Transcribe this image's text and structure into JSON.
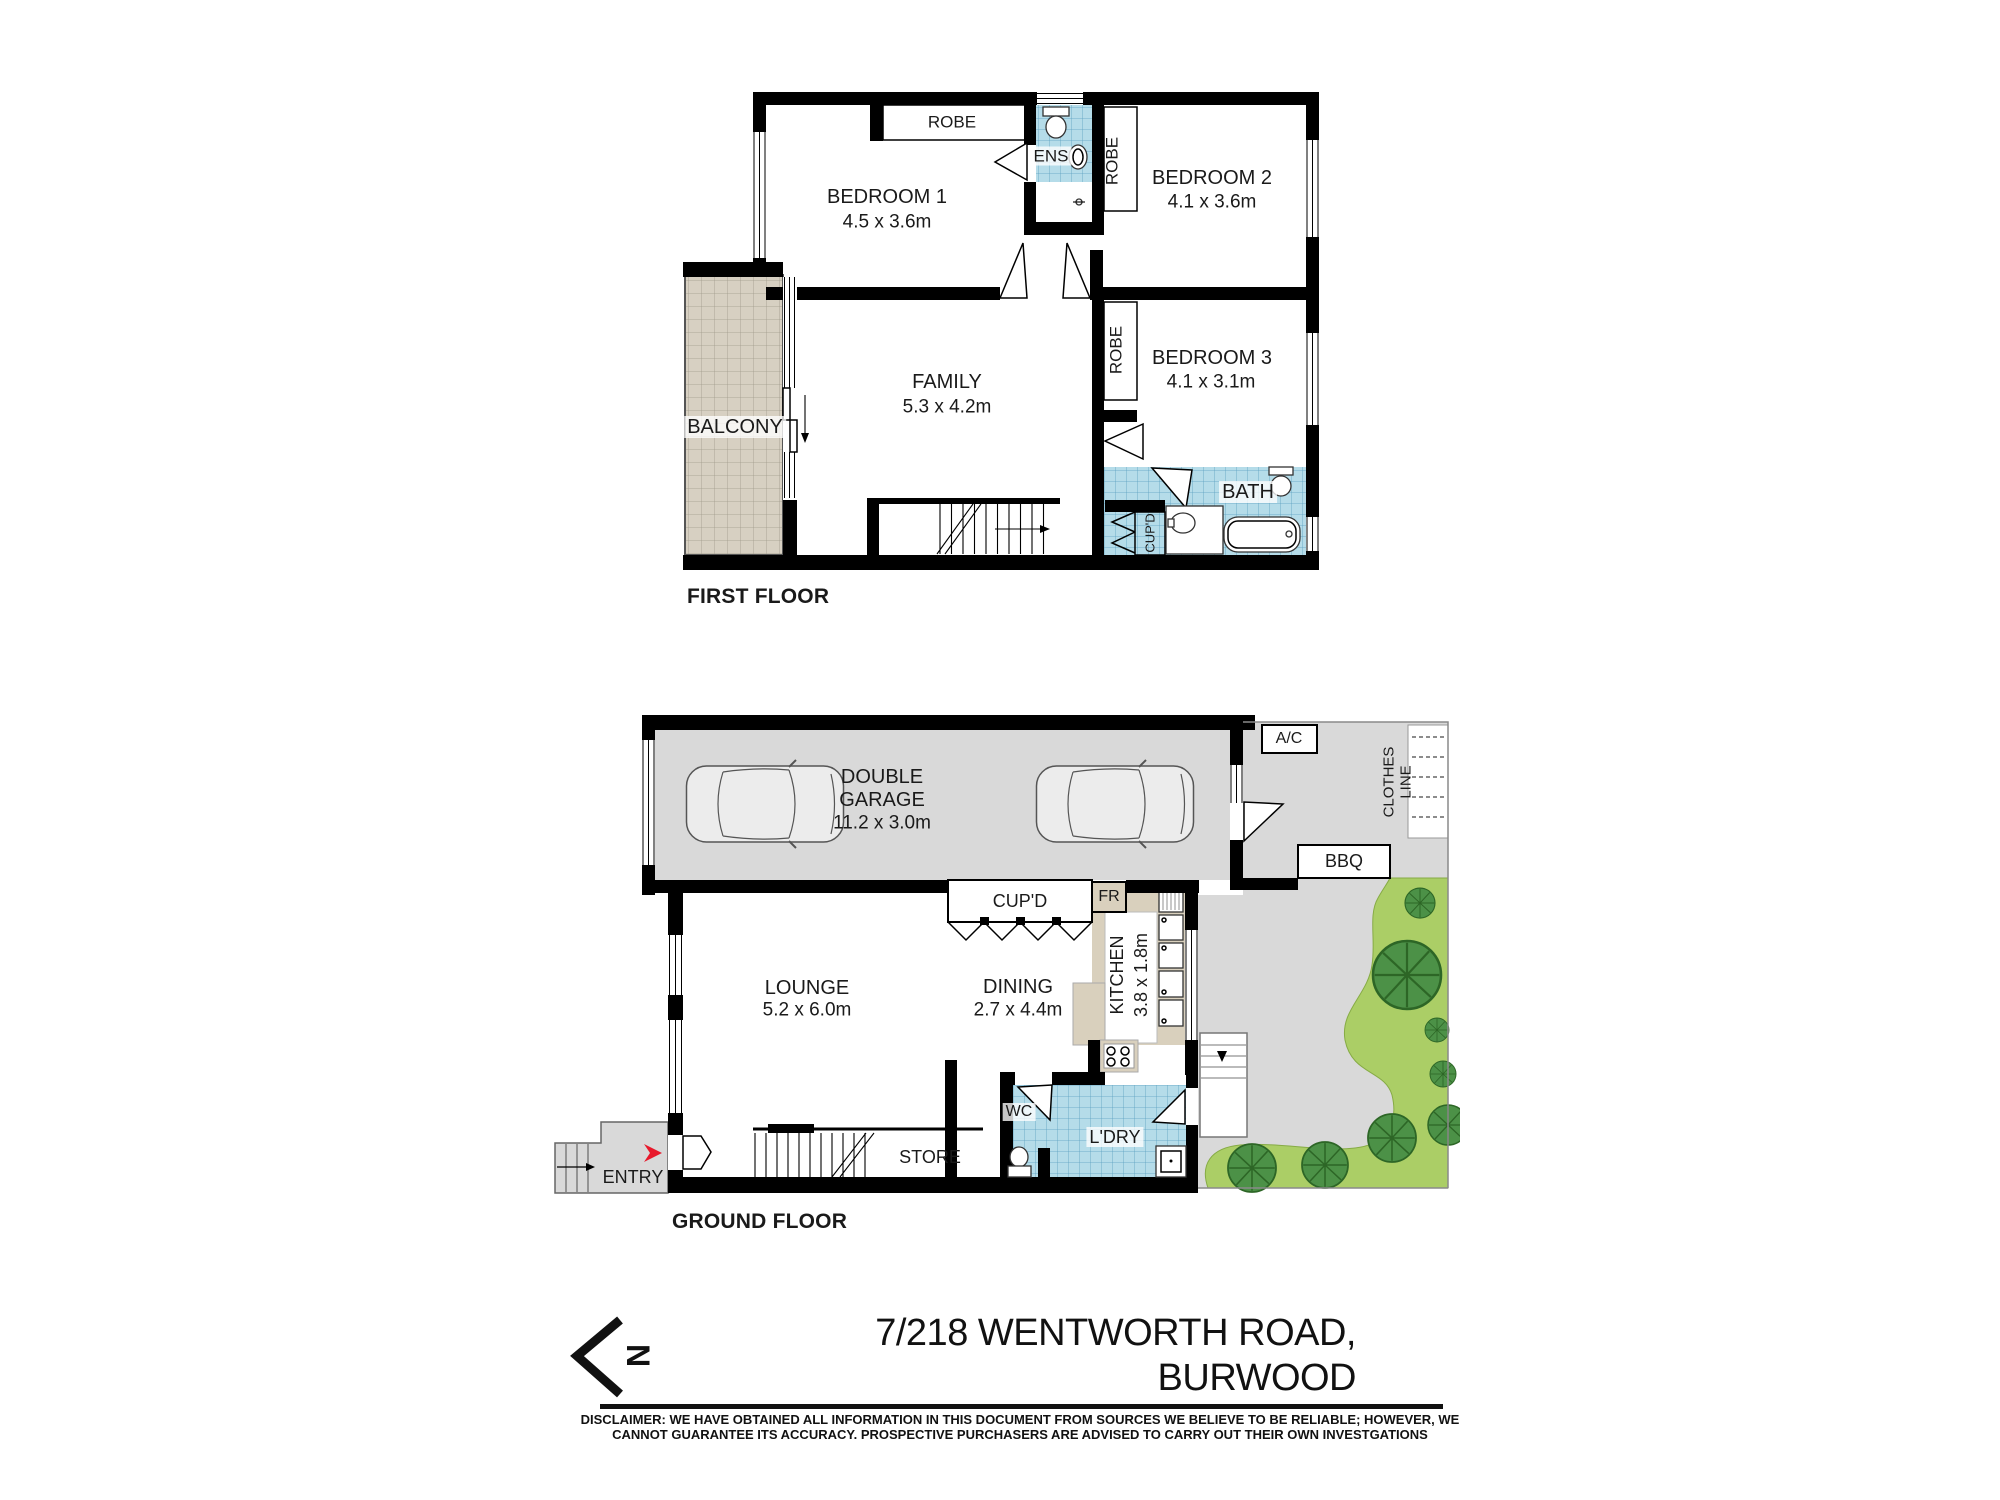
{
  "address": {
    "line1": "7/218 WENTWORTH ROAD,",
    "line2": "BURWOOD"
  },
  "disclaimer": {
    "line1": "DISCLAIMER: WE HAVE OBTAINED ALL INFORMATION IN THIS DOCUMENT FROM SOURCES WE BELIEVE TO BE RELIABLE; HOWEVER, WE",
    "line2": "CANNOT GUARANTEE ITS ACCURACY. PROSPECTIVE PURCHASERS ARE ADVISED TO CARRY OUT THEIR OWN INVESTGATIONS"
  },
  "compass": {
    "letter": "N"
  },
  "first_floor": {
    "title": "FIRST FLOOR",
    "bedroom1": {
      "name": "BEDROOM 1",
      "dims": "4.5 x 3.6m"
    },
    "bedroom2": {
      "name": "BEDROOM 2",
      "dims": "4.1 x 3.6m"
    },
    "bedroom3": {
      "name": "BEDROOM 3",
      "dims": "4.1 x 3.1m"
    },
    "family": {
      "name": "FAMILY",
      "dims": "5.3 x 4.2m"
    },
    "balcony": {
      "name": "BALCONY"
    },
    "ens": {
      "name": "ENS"
    },
    "bath": {
      "name": "BATH"
    },
    "robe_bedroom1": {
      "name": "ROBE"
    },
    "robe_bedroom2": {
      "name": "ROBE"
    },
    "robe_bedroom3": {
      "name": "ROBE"
    },
    "cupboard": {
      "name": "CUP'D"
    }
  },
  "ground_floor": {
    "title": "GROUND FLOOR",
    "garage": {
      "name_line1": "DOUBLE",
      "name_line2": "GARAGE",
      "dims": "11.2 x 3.0m"
    },
    "lounge": {
      "name": "LOUNGE",
      "dims": "5.2 x 6.0m"
    },
    "dining": {
      "name": "DINING",
      "dims": "2.7 x 4.4m"
    },
    "kitchen": {
      "name": "KITCHEN",
      "dims": "3.8 x 1.8m"
    },
    "cupboard": {
      "name": "CUP'D"
    },
    "fridge": {
      "name": "FR"
    },
    "wc": {
      "name": "WC"
    },
    "laundry": {
      "name": "L'DRY"
    },
    "store": {
      "name": "STORE"
    },
    "entry": {
      "name": "ENTRY"
    },
    "air_conditioner": {
      "name": "A/C"
    },
    "bbq": {
      "name": "BBQ"
    },
    "clothes_line": {
      "line1": "CLOTHES",
      "line2": "LINE"
    }
  },
  "colors": {
    "wall_black": "#000000",
    "tile_blue": "#b5dce9",
    "tile_line": "#5b9fc0",
    "balcony_tile": "#d7d0c2",
    "balcony_line": "#a09a8a",
    "floor_gray": "#d9d9d9",
    "kitchen_tan": "#d9d0bd",
    "lawn_green": "#abce66",
    "lawn_edge": "#86ab45",
    "tree_green": "#4c9147",
    "tree_line": "#2d6626",
    "arrow_red": "#e8192c"
  }
}
